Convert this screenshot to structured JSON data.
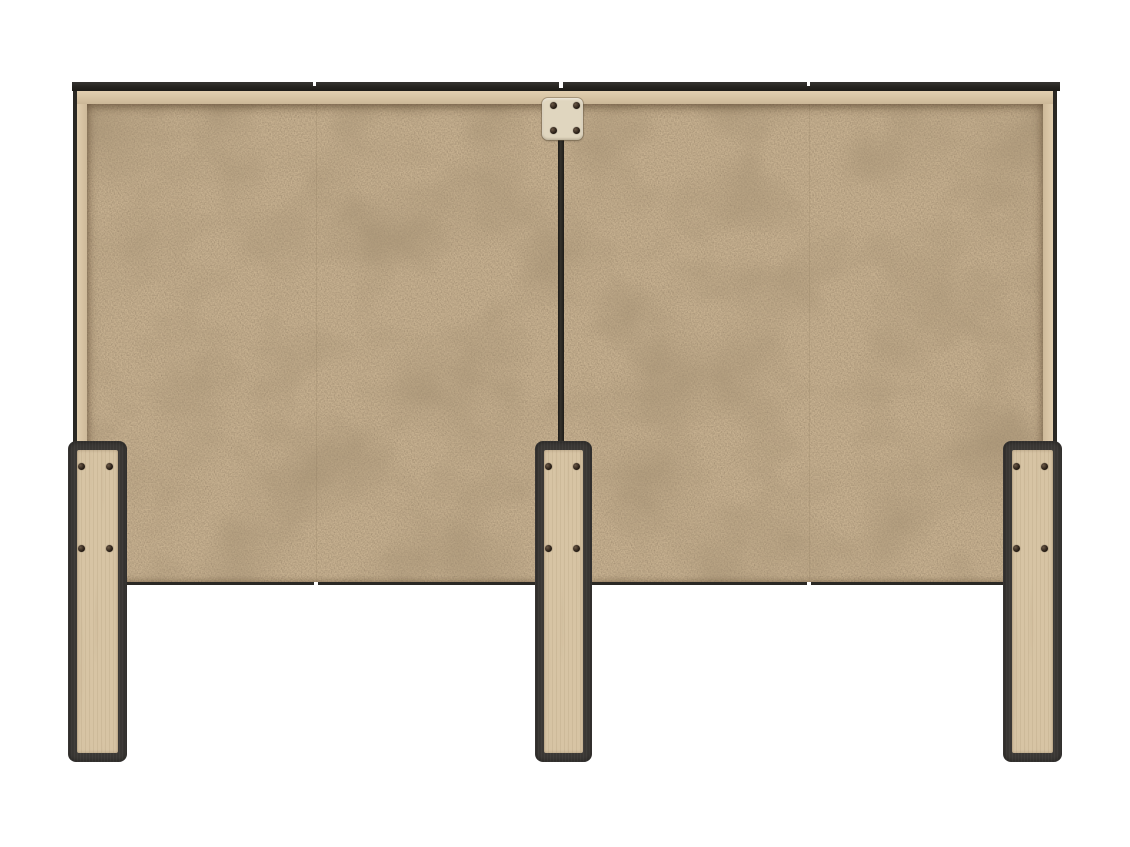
{
  "scene": {
    "type": "product-render",
    "subject": "headboard back view",
    "background": "#ffffff"
  },
  "colors": {
    "background": "#ffffff",
    "panel": "#c7b190",
    "panel_edge": "#d8c5a5",
    "trim": "#2a2824",
    "seam": "#23211d",
    "leg_frame": "#3b3835",
    "leg_wood": "#d7c4a4",
    "bracket": "#e0d6bf",
    "screw": "#231a12"
  },
  "parts": {
    "panel": {
      "name": "particle-board-back-panel",
      "sections": 2
    },
    "center_seam": {
      "name": "center-seam"
    },
    "bracket_plate": {
      "name": "connector-bracket-plate",
      "screw_count": 4
    },
    "legs": {
      "name": "headboard-legs",
      "count": 3,
      "screws_per_leg": 4
    }
  }
}
